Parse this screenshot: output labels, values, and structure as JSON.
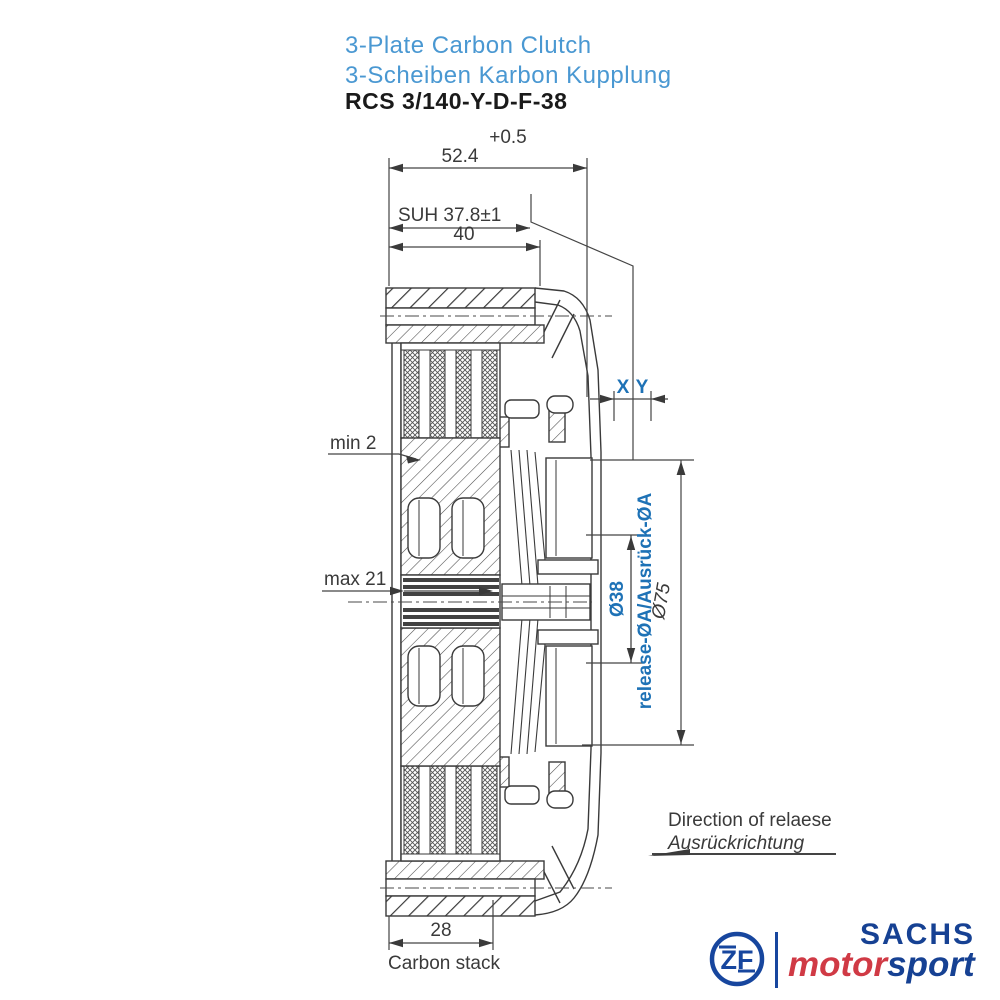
{
  "header": {
    "title_en": "3-Plate Carbon Clutch",
    "title_de": "3-Scheiben Karbon Kupplung",
    "part_number": "RCS 3/140-Y-D-F-38"
  },
  "drawing": {
    "dimensions": {
      "overall_width": "52.4",
      "overall_width_tolerance": "+0.5",
      "suh": "SUH 37.8±1",
      "width_40": "40",
      "min_wear": "min 2",
      "max_wear": "max 21",
      "x_gap": "X",
      "y_gap": "Y",
      "release_diameter": "Ø38",
      "release_diameter_note": "release-ØA/Ausrück-ØA",
      "outer_diameter": "Ø75",
      "carbon_stack_width": "28",
      "carbon_stack_label": "Carbon stack"
    },
    "annotations": {
      "direction_en": "Direction of relaese",
      "direction_de": "Ausrückrichtung"
    }
  },
  "footer": {
    "logo": {
      "zf_letters": "ZF",
      "brand": "SACHS",
      "motorsport_motor": "motor",
      "motorsport_sport": "sport"
    }
  },
  "colors": {
    "title_blue": "#4a98d2",
    "dimension_blue": "#1e72b6",
    "drawing_line": "#3a3a3a",
    "zf_blue": "#17469e",
    "sachs_blue": "#164193",
    "motor_red": "#d03a45"
  }
}
